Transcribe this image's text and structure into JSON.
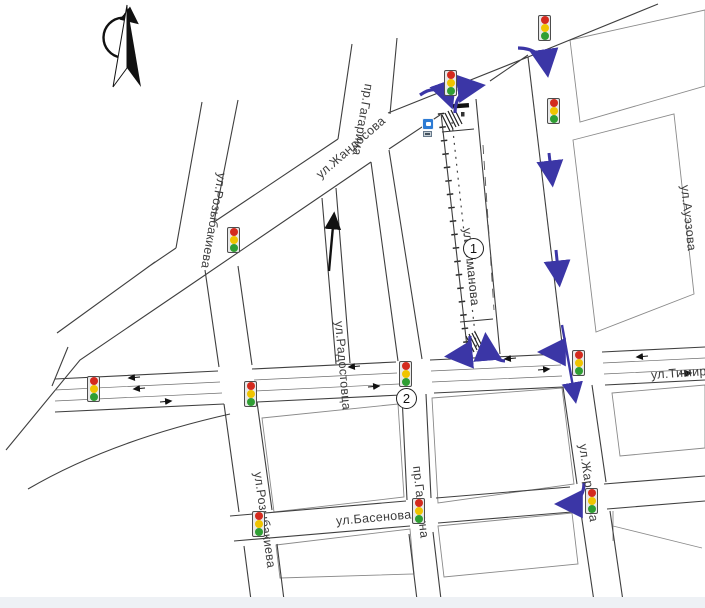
{
  "streets": {
    "zhandosova": "ул.Жандосова",
    "rozybakieva_top": "ул.Розыбакиева",
    "rozybakieva_bottom": "ул.Розыбакиева",
    "gagarina_top": "пр.Гагарина",
    "gagarina_bottom": "пр.Гагарина",
    "radostovtsa": "ул.Радостовца",
    "aimanova": "ул.Айманова",
    "auezova": "ул.Ауэзова",
    "timiryazeva": "ул.Тимирязева",
    "zharokova": "ул.Жарокова",
    "basenova": "ул.Басенова"
  },
  "markers": {
    "closed_section": "1",
    "detour_intersection": "2"
  },
  "colors": {
    "detour_arrow_blue": "#3b36a6",
    "direction_arrow_black": "#111111",
    "traffic_red": "#d42a1e",
    "traffic_yellow": "#f0c400",
    "traffic_green": "#2f9e33",
    "sign_blue": "#2d7bd4",
    "road_line": "#3f3f3f"
  }
}
